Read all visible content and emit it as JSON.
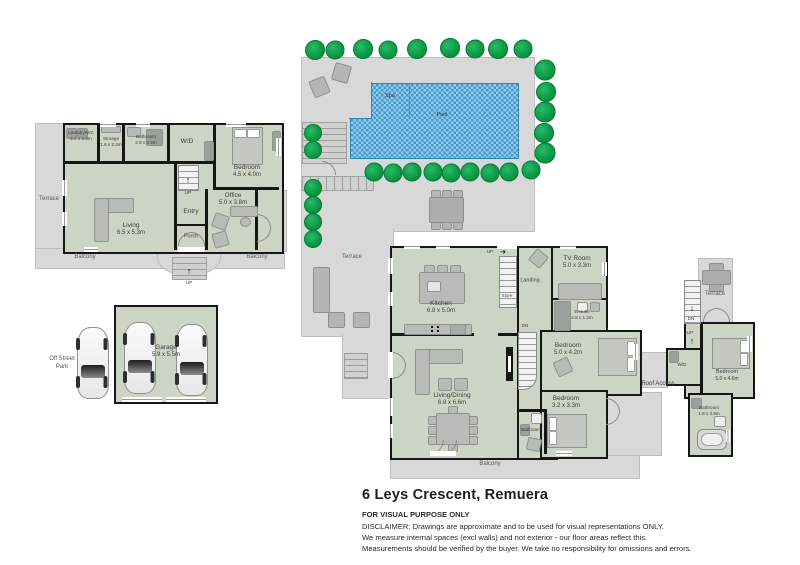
{
  "document": {
    "title": "6 Leys Crescent, Remuera",
    "purpose": "FOR VISUAL PURPOSE ONLY",
    "disclaimer": [
      "DISCLAIMER:  Drawings are approximate and to be used for visual representations ONLY.",
      "We measure internal spaces (excl walls) and not exterior - our floor areas reflect this.",
      "Measurements should be verified by the buyer. We take no responsibility for omissions and errors."
    ]
  },
  "colors": {
    "room_fill": "#ccd4c5",
    "outdoor_fill": "#d8d8d8",
    "wall": "#161616",
    "pool_water": "#57b0de",
    "tree": "#0b9c47",
    "label": "#3d3d3d"
  },
  "icons": {
    "up_arrow": "↑",
    "down_arrow": "↓",
    "right_arrow": "➔"
  },
  "upper_floor": {
    "rooms": {
      "laundry": {
        "name": "Laundry/WC",
        "dims": "2.2 x 2.3m"
      },
      "storage": {
        "name": "Storage",
        "dims": "1.6 x 2.2m"
      },
      "bathroom": {
        "name": "Bathroom",
        "dims": "2.8 x 2.2m"
      },
      "wd": {
        "name": "W/D"
      },
      "bedroom": {
        "name": "Bedroom",
        "dims": "4.5 x 4.0m"
      },
      "living": {
        "name": "Living",
        "dims": "6.5 x 5.3m"
      },
      "entry": {
        "name": "Entry"
      },
      "office": {
        "name": "Office",
        "dims": "5.0 x 3.8m"
      },
      "porch": {
        "name": "Porch"
      }
    },
    "outdoor": {
      "terrace": "Terrace",
      "balcony_left": "Balcony",
      "balcony_right": "Balcony",
      "stairs_up": "UP",
      "porch_up": "UP"
    }
  },
  "pool_area": {
    "spa": "Spa",
    "pool": "Pool",
    "terrace": "Terrace"
  },
  "middle_floor": {
    "rooms": {
      "kitchen": {
        "name": "Kitchen",
        "dims": "6.8 x 5.0m"
      },
      "landing": {
        "name": "Landing"
      },
      "store": {
        "name": "Store"
      },
      "tv_room": {
        "name": "TV Room",
        "dims": "5.0 x 3.3m"
      },
      "ensuite": {
        "name": "Ensuite",
        "dims": "2.8 x 1.2m"
      },
      "bedroom_main": {
        "name": "Bedroom",
        "dims": "5.0 x 4.2m"
      },
      "living_dining": {
        "name": "Living/Dining",
        "dims": "6.8 x 6.6m"
      },
      "bedroom_small": {
        "name": "Bedroom",
        "dims": "3.2 x 3.3m"
      },
      "bathroom": {
        "name": "Bathroom"
      }
    },
    "labels": {
      "up": "UP",
      "dn": "DN",
      "balcony": "Balcony"
    }
  },
  "top_floor": {
    "rooms": {
      "terrace": {
        "name": "Terrace"
      },
      "wd": {
        "name": "W/D"
      },
      "bedroom": {
        "name": "Bedroom",
        "dims": "5.0 x 4.6m"
      },
      "bathroom": {
        "name": "Bathroom",
        "dims": "1.8 x 3.6m"
      }
    },
    "labels": {
      "dn": "DN",
      "up": "UP",
      "roof_access": "Roof Access"
    }
  },
  "garage_area": {
    "garage": {
      "name": "Garage",
      "dims": "5.9 x 5.5m"
    },
    "off_street": "Off Street Park"
  }
}
